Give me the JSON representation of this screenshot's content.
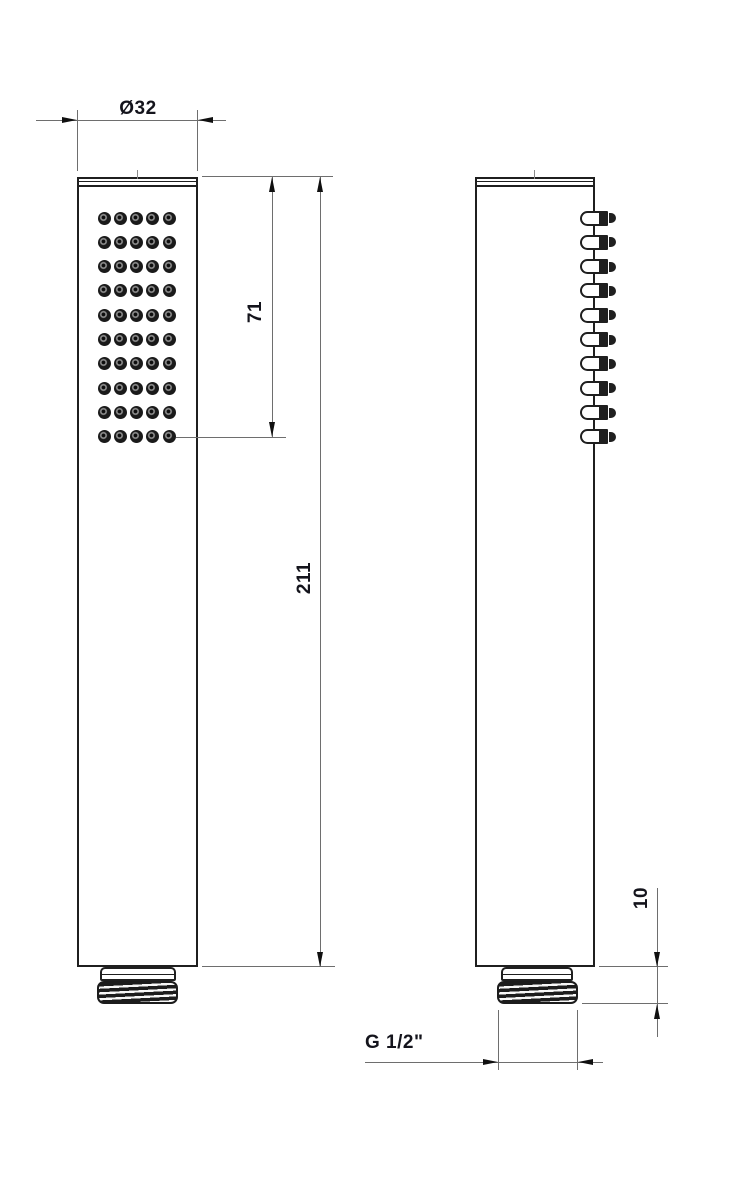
{
  "drawing": {
    "type": "technical-dimension-drawing",
    "subject": "handheld shower head, front and side orthographic views",
    "background": "#ffffff",
    "colors": {
      "outline": "#1f1f1f",
      "dimension_line": "#6e6e6e",
      "arrow": "#101010",
      "text": "#14141c"
    },
    "labels": {
      "diameter": "Ø32",
      "spray_face_length": "71",
      "total_length": "211",
      "thread_length": "10",
      "thread_spec": "G 1/2\""
    },
    "front_view": {
      "nozzle_rows": 10,
      "nozzle_cols": 5
    },
    "side_view": {
      "nozzle_count": 10
    }
  }
}
